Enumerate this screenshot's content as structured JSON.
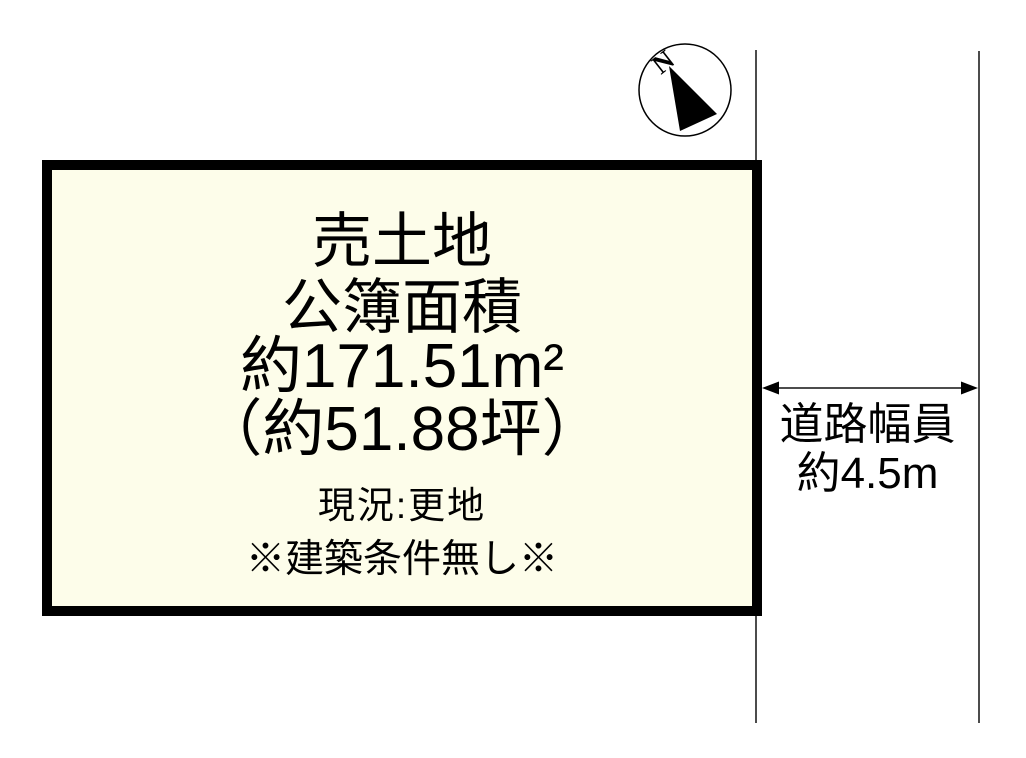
{
  "colors": {
    "background": "#ffffff",
    "plot-fill": "#fdfdea",
    "ink": "#000000"
  },
  "plot": {
    "lines": [
      "売土地",
      "公簿面積",
      "約171.51m²",
      "（約51.88坪）",
      "現況:更地",
      "※建築条件無し※"
    ]
  },
  "road": {
    "name": "道路幅員",
    "width": "約4.5m"
  },
  "compass": {
    "north": "N"
  }
}
